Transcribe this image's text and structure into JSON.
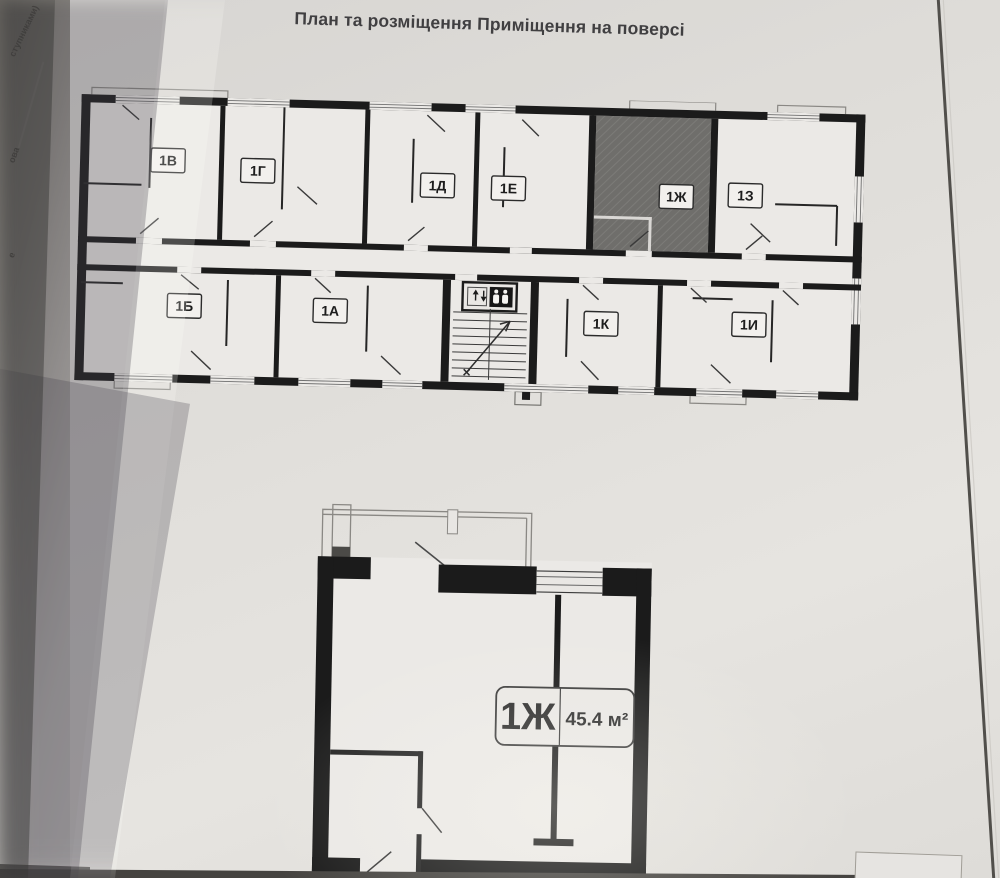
{
  "page": {
    "title": "План та розміщення Приміщення на поверсі"
  },
  "photo": {
    "paper_color": "#e3e1de",
    "wall_color": "#1b1b1b",
    "highlight_fill": "#6f6e6b",
    "shadow_color": "rgba(72,68,78,0.30)"
  },
  "prev_page_edge": {
    "fragments": [
      "ступниками)",
      "ова",
      "е"
    ]
  },
  "floor_plan": {
    "top_row_units": [
      {
        "label": "1В",
        "highlighted": false
      },
      {
        "label": "1Г",
        "highlighted": false
      },
      {
        "label": "1Д",
        "highlighted": false
      },
      {
        "label": "1Е",
        "highlighted": false
      },
      {
        "label": "1Ж",
        "highlighted": true
      },
      {
        "label": "1З",
        "highlighted": false
      }
    ],
    "bottom_row_units": [
      {
        "label": "1Б",
        "highlighted": false
      },
      {
        "label": "1А",
        "highlighted": false
      },
      {
        "label": "1К",
        "highlighted": false
      },
      {
        "label": "1И",
        "highlighted": false
      }
    ],
    "highlighted_unit": "1Ж",
    "icons": {
      "elevator": "elevator-up-down-people-icon",
      "stairs": "stairs-direction-arrow-icon"
    }
  },
  "unit_detail": {
    "unit_label": "1Ж",
    "area": "45.4 м²"
  }
}
